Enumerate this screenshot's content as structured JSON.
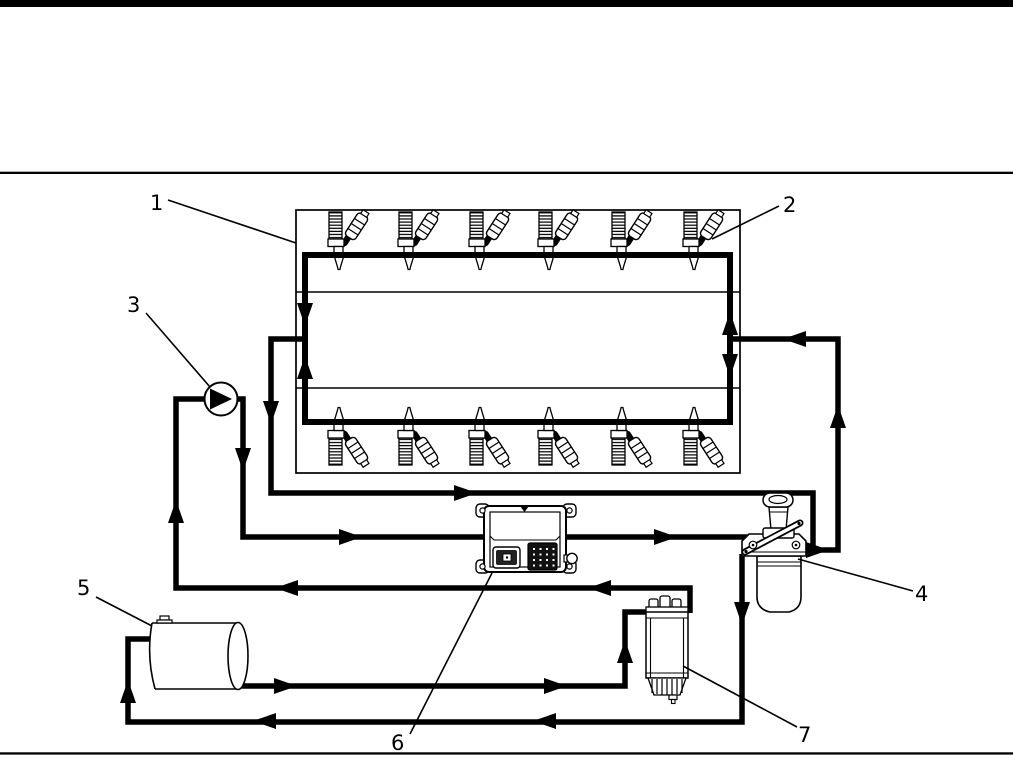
{
  "palette": {
    "ink": "#000000",
    "paper": "#ffffff"
  },
  "figure": {
    "kind": "engine-fuel-system-schematic",
    "callouts": [
      {
        "label": "1",
        "points_to": "engine-block"
      },
      {
        "label": "2",
        "points_to": "fuel-injector"
      },
      {
        "label": "3",
        "points_to": "fuel-transfer-pump"
      },
      {
        "label": "4",
        "points_to": "secondary-fuel-filter-priming-pump"
      },
      {
        "label": "5",
        "points_to": "fuel-tank"
      },
      {
        "label": "6",
        "points_to": "engine-control-module"
      },
      {
        "label": "7",
        "points_to": "primary-fuel-filter-water-separator"
      }
    ],
    "injectors": {
      "top_row_count": 6,
      "bottom_row_count": 6
    }
  }
}
